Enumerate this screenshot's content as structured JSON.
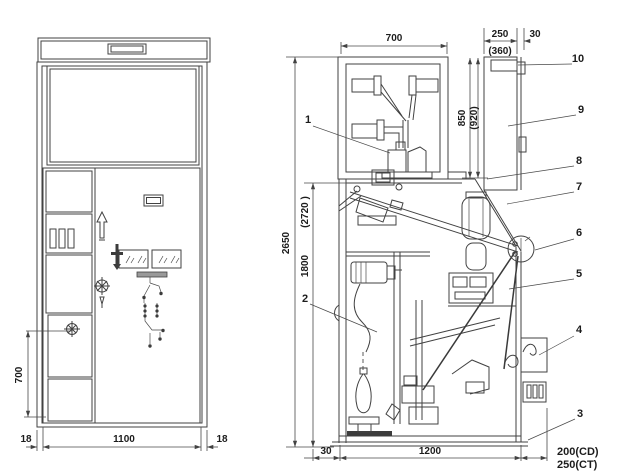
{
  "front_view": {
    "dim_door_height": "700",
    "dim_left_frame": "18",
    "dim_width": "1100",
    "dim_right_frame": "18"
  },
  "side_view": {
    "dim_busbar_width": "700",
    "dim_rear_width": "250",
    "dim_rear_gap": "30",
    "dim_rear_width_alt": "(360)",
    "dim_rear_height": "850",
    "dim_rear_height_alt": "(920)",
    "dim_total_height": "2650",
    "dim_total_height_alt": "(2720 )",
    "dim_body_height": "1800",
    "dim_front_gap": "30",
    "dim_depth": "1200",
    "dim_ext_cd": "200(CD)",
    "dim_ext_ct": "250(CT)"
  },
  "callouts": {
    "c1": "1",
    "c2": "2",
    "c3": "3",
    "c4": "4",
    "c5": "5",
    "c6": "6",
    "c7": "7",
    "c8": "8",
    "c9": "9",
    "c10": "10"
  }
}
